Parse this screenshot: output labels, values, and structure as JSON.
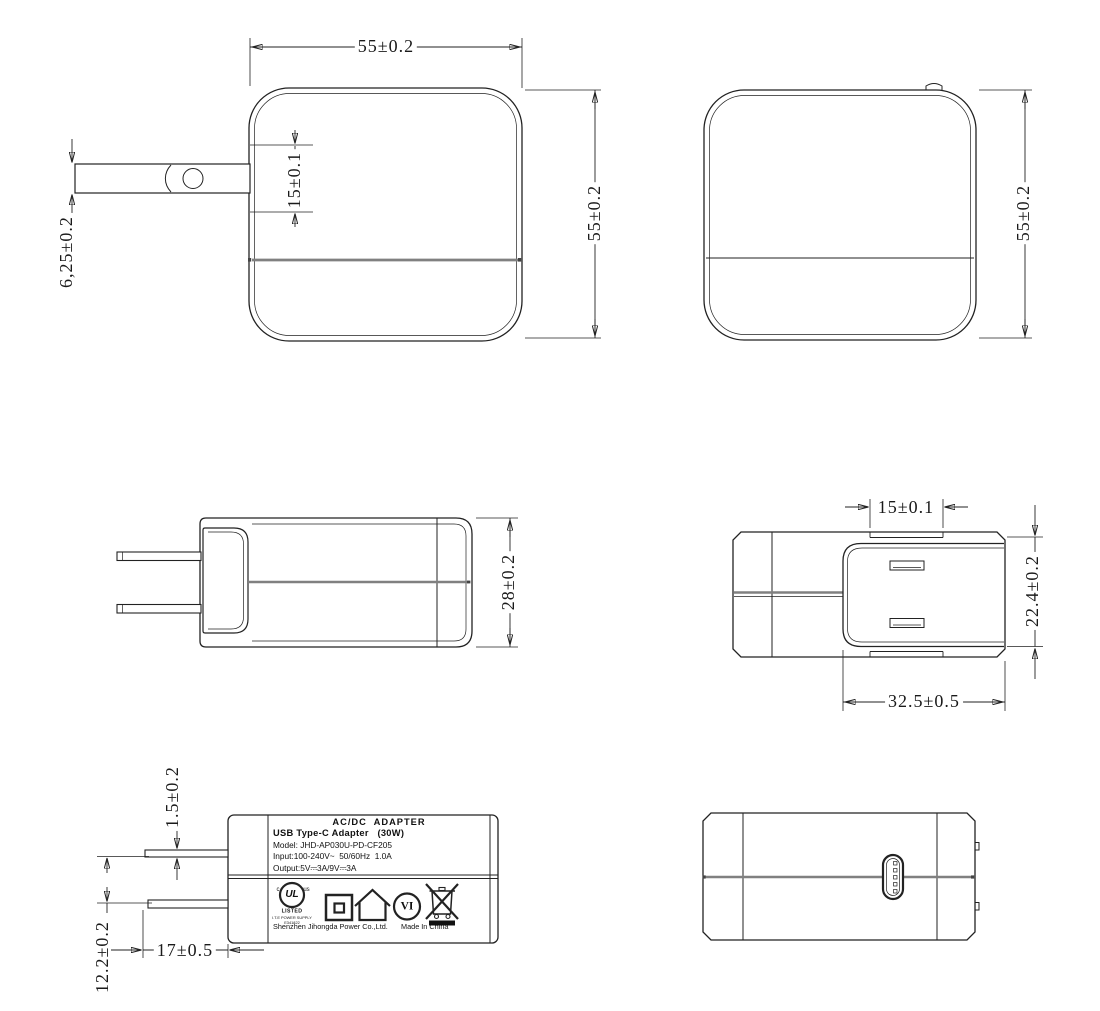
{
  "colors": {
    "line": "#222222",
    "seam_gray": "#808080",
    "background": "#ffffff",
    "fill_black": "#111111"
  },
  "views": {
    "front": {
      "dim_width": "55±0.2",
      "dim_height": "55±0.2",
      "dim_prong_offset": "15±0.1",
      "dim_prong_width": "6,25±0.2"
    },
    "rear": {
      "dim_height": "55±0.2"
    },
    "side": {
      "dim_depth": "28±0.2"
    },
    "top": {
      "dim_prong_gap": "15±0.1",
      "dim_module_height": "22.4±0.2",
      "dim_module_width": "32.5±0.5"
    },
    "label": {
      "dim_prong_thickness": "1.5±0.2",
      "dim_prong_spacing": "12.2±0.2",
      "dim_prong_length": "17±0.5",
      "title": "AC/DC  ADAPTER",
      "subtitle": "USB Type-C Adapter   (30W)",
      "model": "Model: JHD-AP030U-PD-CF205",
      "input": "Input:100-240V~  50/60Hz  1.0A",
      "output": "Output:5V⎓3A/9V⎓3A",
      "ul_c": "c",
      "ul_mark": "UL",
      "ul_us": "us",
      "ul_listed": "LISTED",
      "ul_category": "I.T.E POWER SUPPLY",
      "ul_file_no": "E341822",
      "efficiency_level": "VI",
      "manufacturer": "Shenzhen Jihongda Power Co.,Ltd.",
      "origin": "Made In China",
      "icons": [
        "ul-listed-mark",
        "double-insulation-icon",
        "indoor-use-icon",
        "efficiency-vi-mark",
        "weee-crossed-bin-icon"
      ]
    },
    "bottom": {
      "feature": "usb-c-port"
    }
  }
}
